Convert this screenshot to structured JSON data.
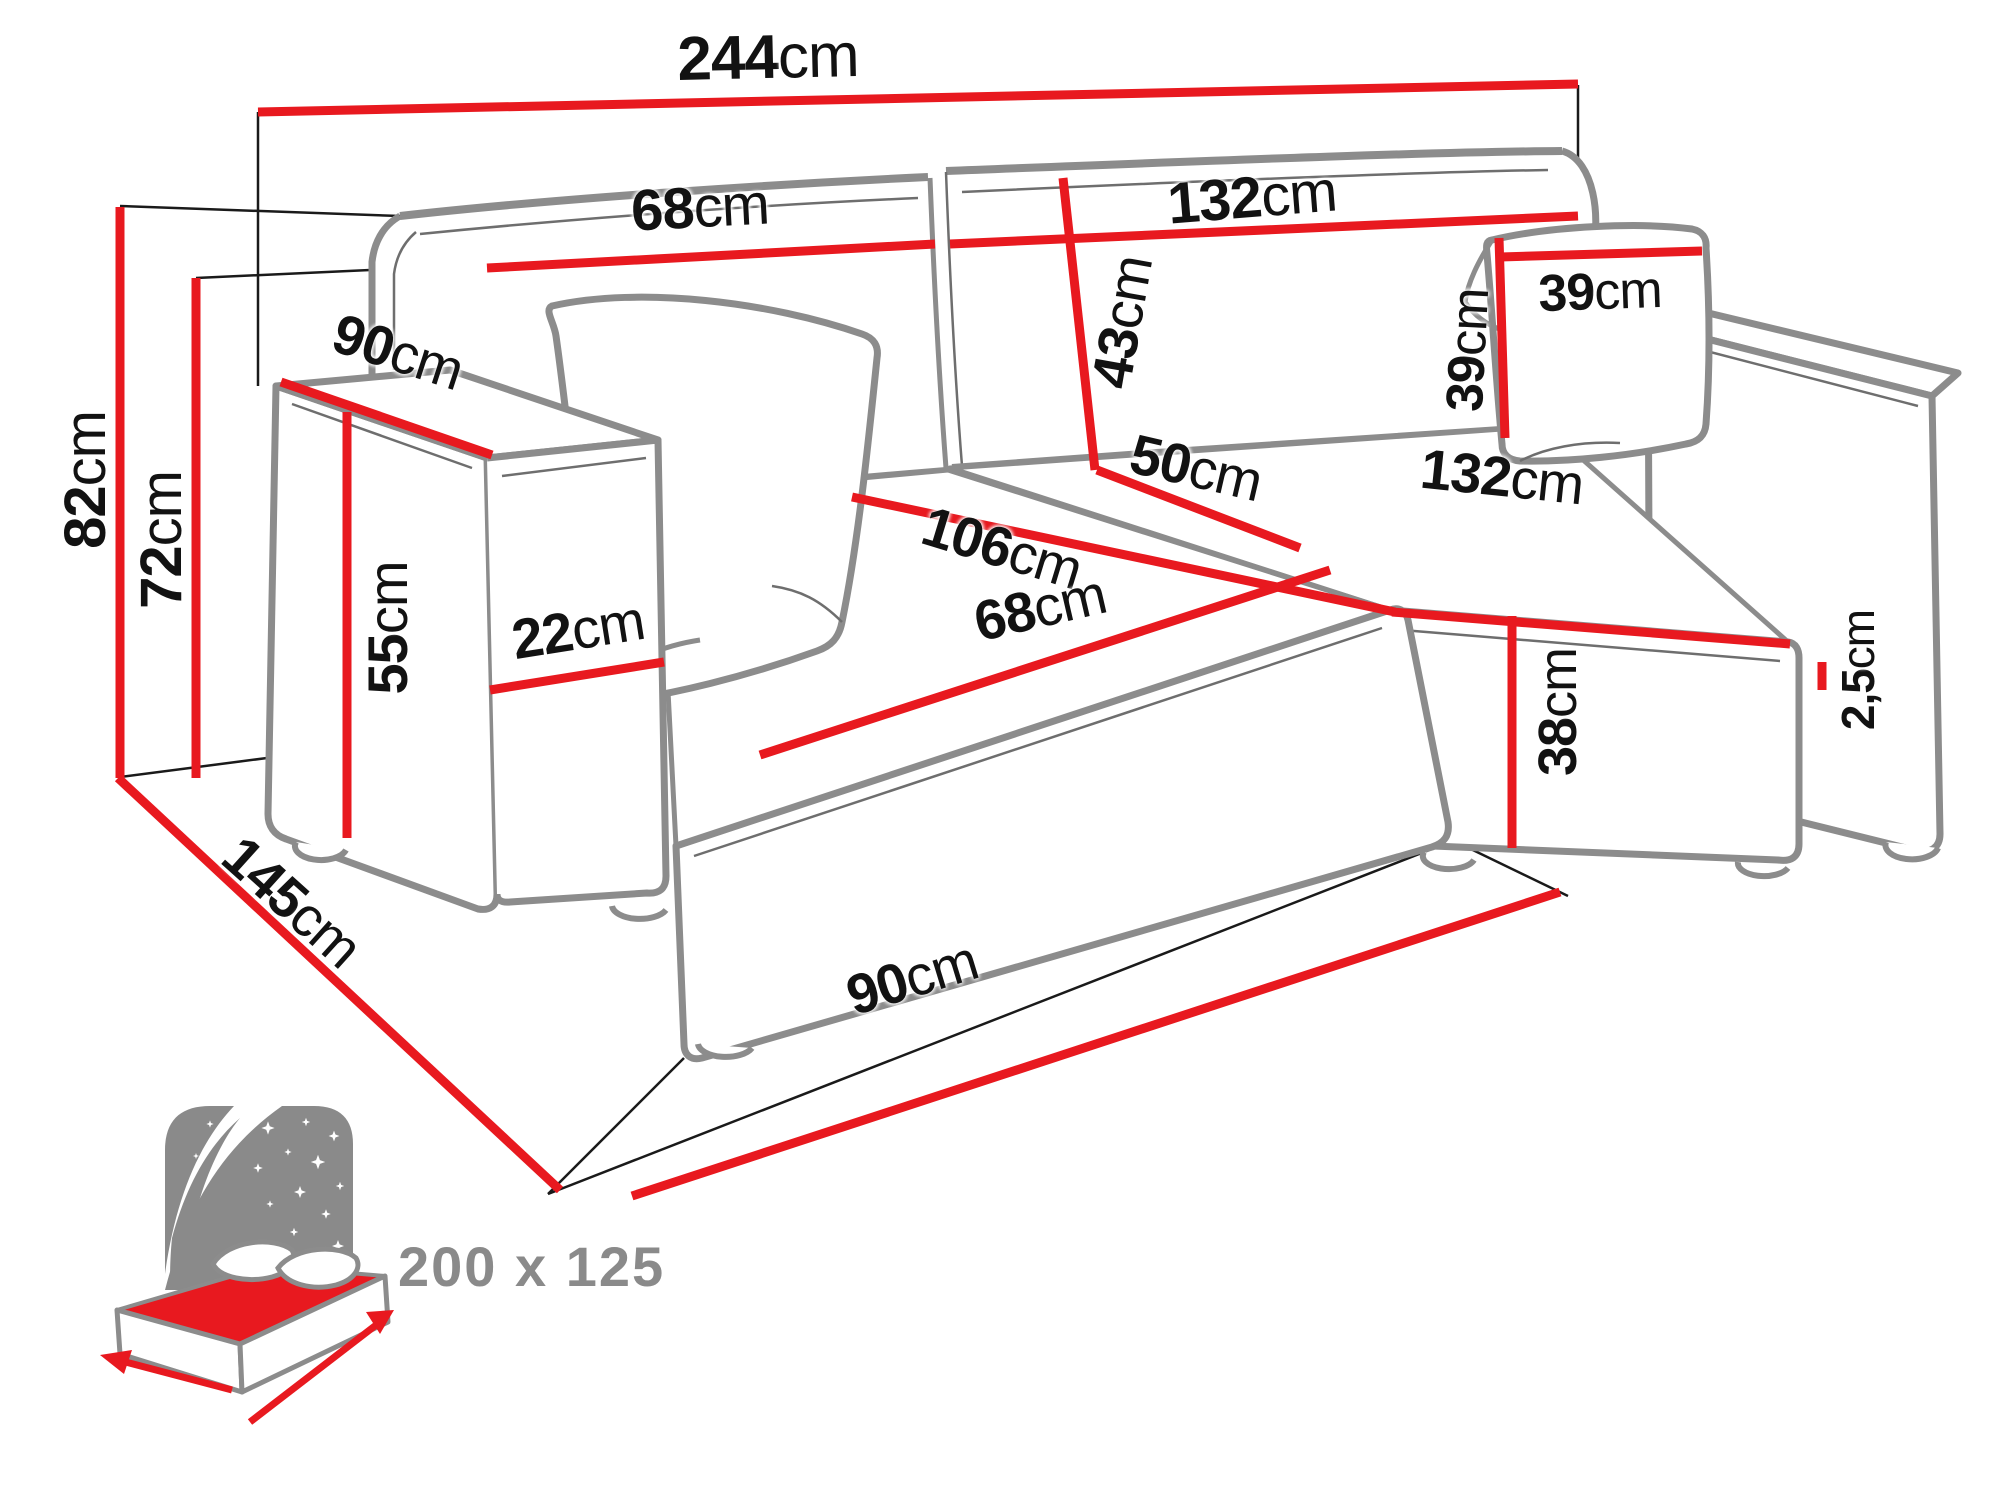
{
  "figure": {
    "type": "furniture dimension diagram",
    "subject": "corner sofa bed with chaise, line drawing with measurements"
  },
  "colors": {
    "dimension_red": "#e8191f",
    "outline_gray": "#8c8c8c",
    "detail_gray": "#6e6e6e",
    "construction_black": "#1a1a1a",
    "label_black": "#121212",
    "icon_gray": "#8a8a8a",
    "background": "#ffffff"
  },
  "dimensions": {
    "total_width": {
      "value": "244",
      "unit": "cm"
    },
    "backrest_left_width": {
      "value": "68",
      "unit": "cm"
    },
    "backrest_right_width": {
      "value": "132",
      "unit": "cm"
    },
    "backrest_height": {
      "value": "43",
      "unit": "cm"
    },
    "pillow_height": {
      "value": "39",
      "unit": "cm"
    },
    "pillow_width": {
      "value": "39",
      "unit": "cm"
    },
    "armrest_top_depth": {
      "value": "90",
      "unit": "cm"
    },
    "total_height": {
      "value": "82",
      "unit": "cm"
    },
    "back_frame_height": {
      "value": "72",
      "unit": "cm"
    },
    "armrest_height": {
      "value": "55",
      "unit": "cm"
    },
    "armrest_width": {
      "value": "22",
      "unit": "cm"
    },
    "chaise_seat_length": {
      "value": "106",
      "unit": "cm"
    },
    "seat_depth": {
      "value": "50",
      "unit": "cm"
    },
    "chaise_seat_width": {
      "value": "68",
      "unit": "cm"
    },
    "seat_front_width": {
      "value": "132",
      "unit": "cm"
    },
    "seat_front_height": {
      "value": "38",
      "unit": "cm"
    },
    "leg_height": {
      "value": "2,5",
      "unit": "cm"
    },
    "chaise_total_depth": {
      "value": "145",
      "unit": "cm"
    },
    "chaise_front_width": {
      "value": "90",
      "unit": "cm"
    }
  },
  "sleeping_area": {
    "size_label": "200 x 125"
  }
}
